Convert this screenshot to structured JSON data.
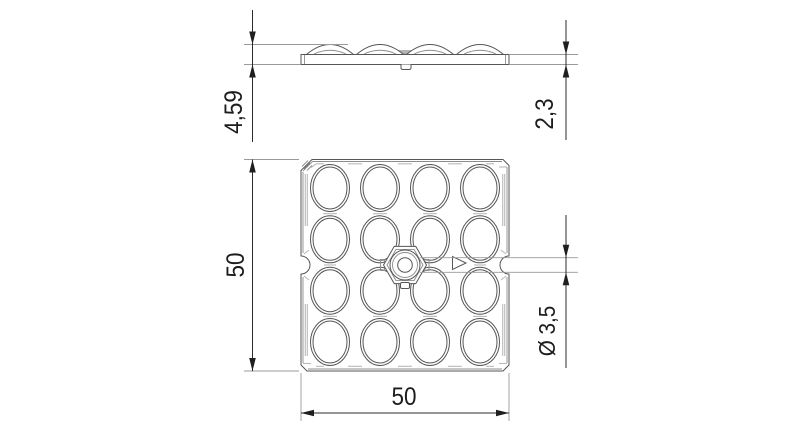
{
  "drawing": {
    "kind": "technical-drawing-two-views",
    "dimensions": {
      "overall_height": "4,59",
      "base_thickness": "2,3",
      "plate_height": "50",
      "plate_width": "50",
      "center_hole_diameter": "Ø 3,5"
    },
    "icons": {
      "orientation_marker": "triangle-right"
    },
    "colors": {
      "background": "#ffffff",
      "part_outline": "#565656",
      "secondary_detail": "#b9b9b9",
      "dimension_line": "#2b2b2b",
      "dimension_text": "#1c1c1c"
    }
  }
}
